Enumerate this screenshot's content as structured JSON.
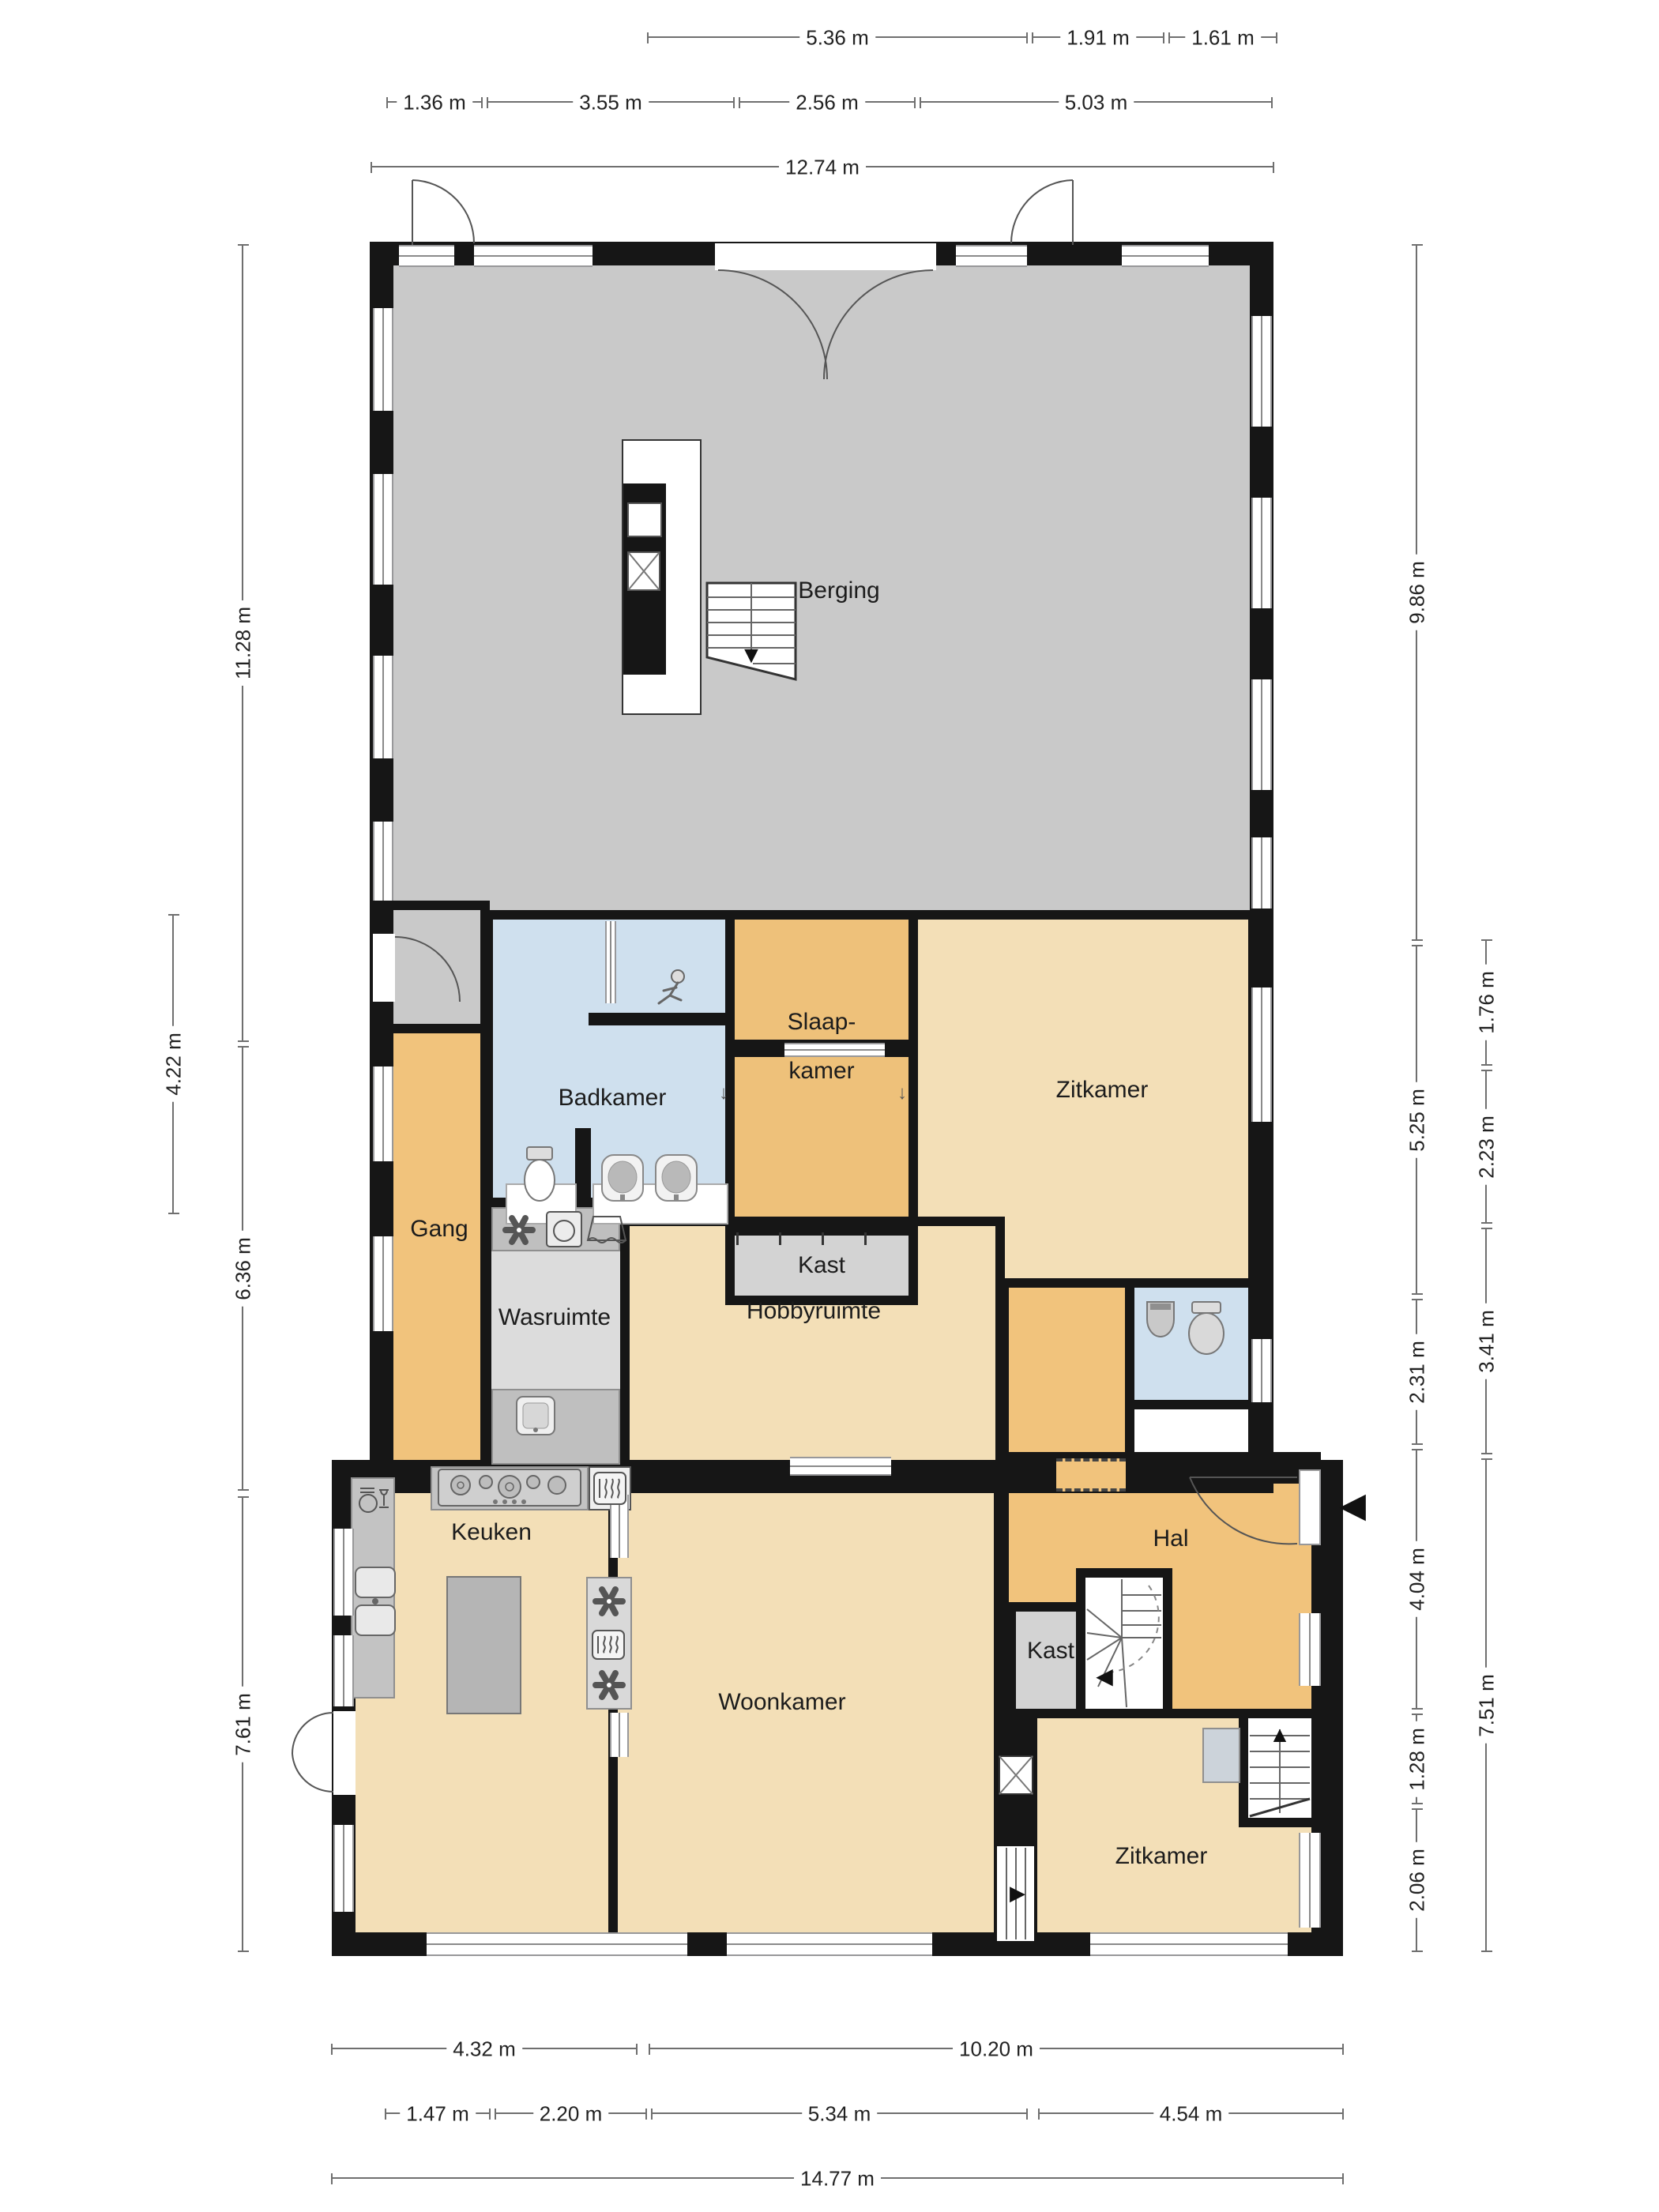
{
  "rooms": {
    "berging": "Berging",
    "badkamer": "Badkamer",
    "slaapkamer_line1": "Slaap-",
    "slaapkamer_line2": "kamer",
    "zitkamer_boven": "Zitkamer",
    "kast_boven": "Kast",
    "gang": "Gang",
    "wasruimte": "Wasruimte",
    "hobbyruimte": "Hobbyruimte",
    "keuken": "Keuken",
    "hal": "Hal",
    "kast_beneden": "Kast",
    "woonkamer": "Woonkamer",
    "zitkamer_beneden": "Zitkamer"
  },
  "dimensions": {
    "top_row1": [
      "5.36 m",
      "1.91 m",
      "1.61 m"
    ],
    "top_row2": [
      "1.36 m",
      "3.55 m",
      "2.56 m",
      "5.03 m"
    ],
    "top_total": "12.74 m",
    "bottom_row1": [
      "4.32 m",
      "10.20 m"
    ],
    "bottom_row2": [
      "1.47 m",
      "2.20 m",
      "5.34 m",
      "4.54 m"
    ],
    "bottom_total": "14.77 m",
    "left_outer": "4.22 m",
    "left_inner": [
      "11.28 m",
      "6.36 m",
      "7.61 m"
    ],
    "right_inner": [
      "9.86 m",
      "5.25 m",
      "2.31 m",
      "4.04 m",
      "1.28 m",
      "2.06 m"
    ],
    "right_outer": [
      "1.76 m",
      "2.23 m",
      "3.41 m",
      "7.51 m"
    ]
  },
  "icons": {
    "entrance_arrow": "◀",
    "stairs_down": "▼",
    "stairs_up": "▲",
    "stairs_right": "▶",
    "stairs_left": "◀",
    "door_swing": "↓"
  },
  "colors": {
    "wall": "#161616",
    "storage_floor": "#c9c9c9",
    "bathroom_floor": "#cfe0ee",
    "orange_floor": "#f1c37c",
    "living_floor": "#f3dfb7",
    "utility_floor": "#dcdcdc",
    "closet_floor": "#d3d3d3"
  }
}
